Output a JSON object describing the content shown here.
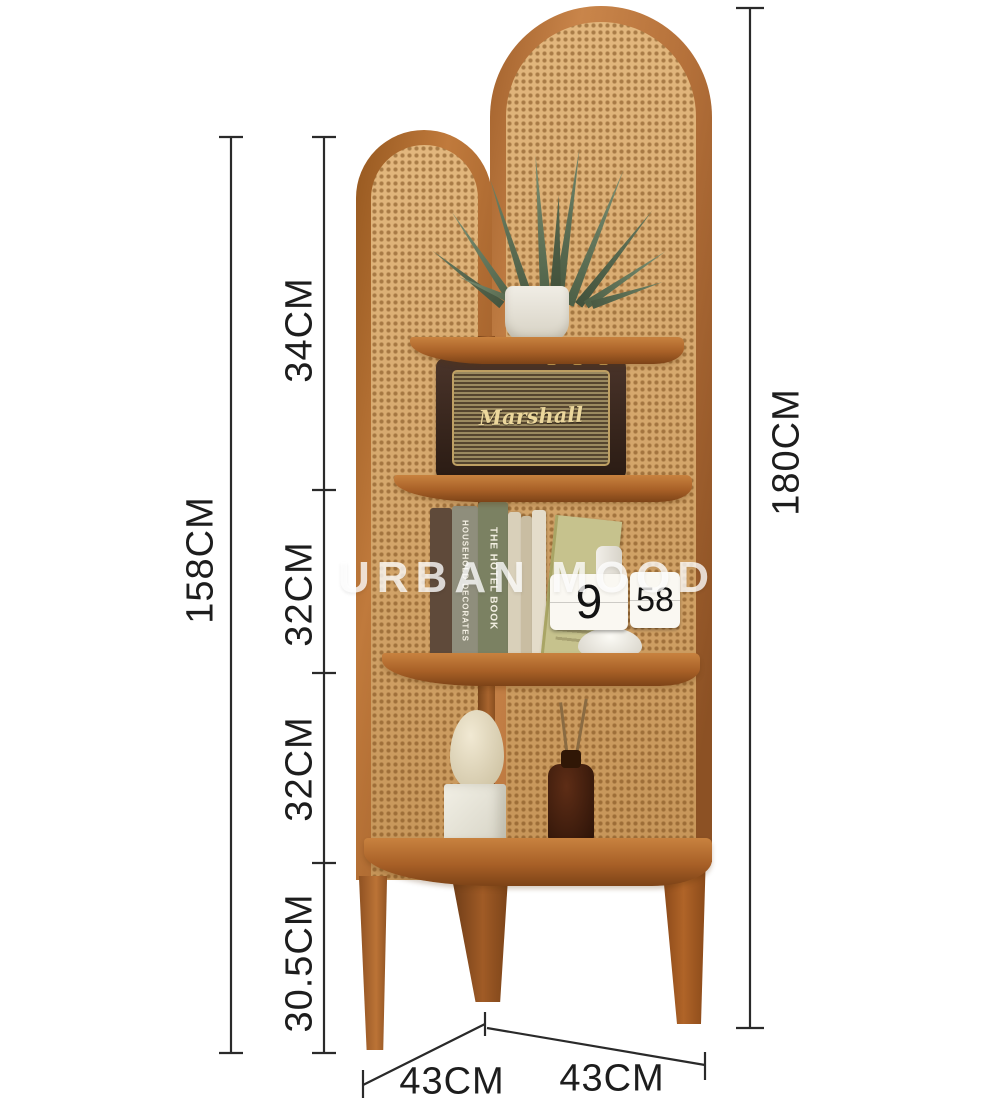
{
  "watermark": {
    "text": "URBAN MOOD"
  },
  "dimensions": {
    "left_total": "158CM",
    "segments": [
      "34CM",
      "32CM",
      "32CM",
      "30.5CM"
    ],
    "right_total": "180CM",
    "depth_left": "43CM",
    "depth_right": "43CM"
  },
  "decor": {
    "speaker_logo": "Marshall",
    "clock_hour": "9",
    "clock_minute": "58",
    "book_spine_1": "HOUSEHOLD DECORATES",
    "book_spine_2": "THE HOTEL BOOK"
  },
  "colors": {
    "wood_frame": "#b06a32",
    "rattan": "#d7a667",
    "dimension_line": "#2a2a2a",
    "watermark_white": "#ffffff",
    "speaker_body": "#2a1b13",
    "leaf_green": "#5c7153"
  }
}
